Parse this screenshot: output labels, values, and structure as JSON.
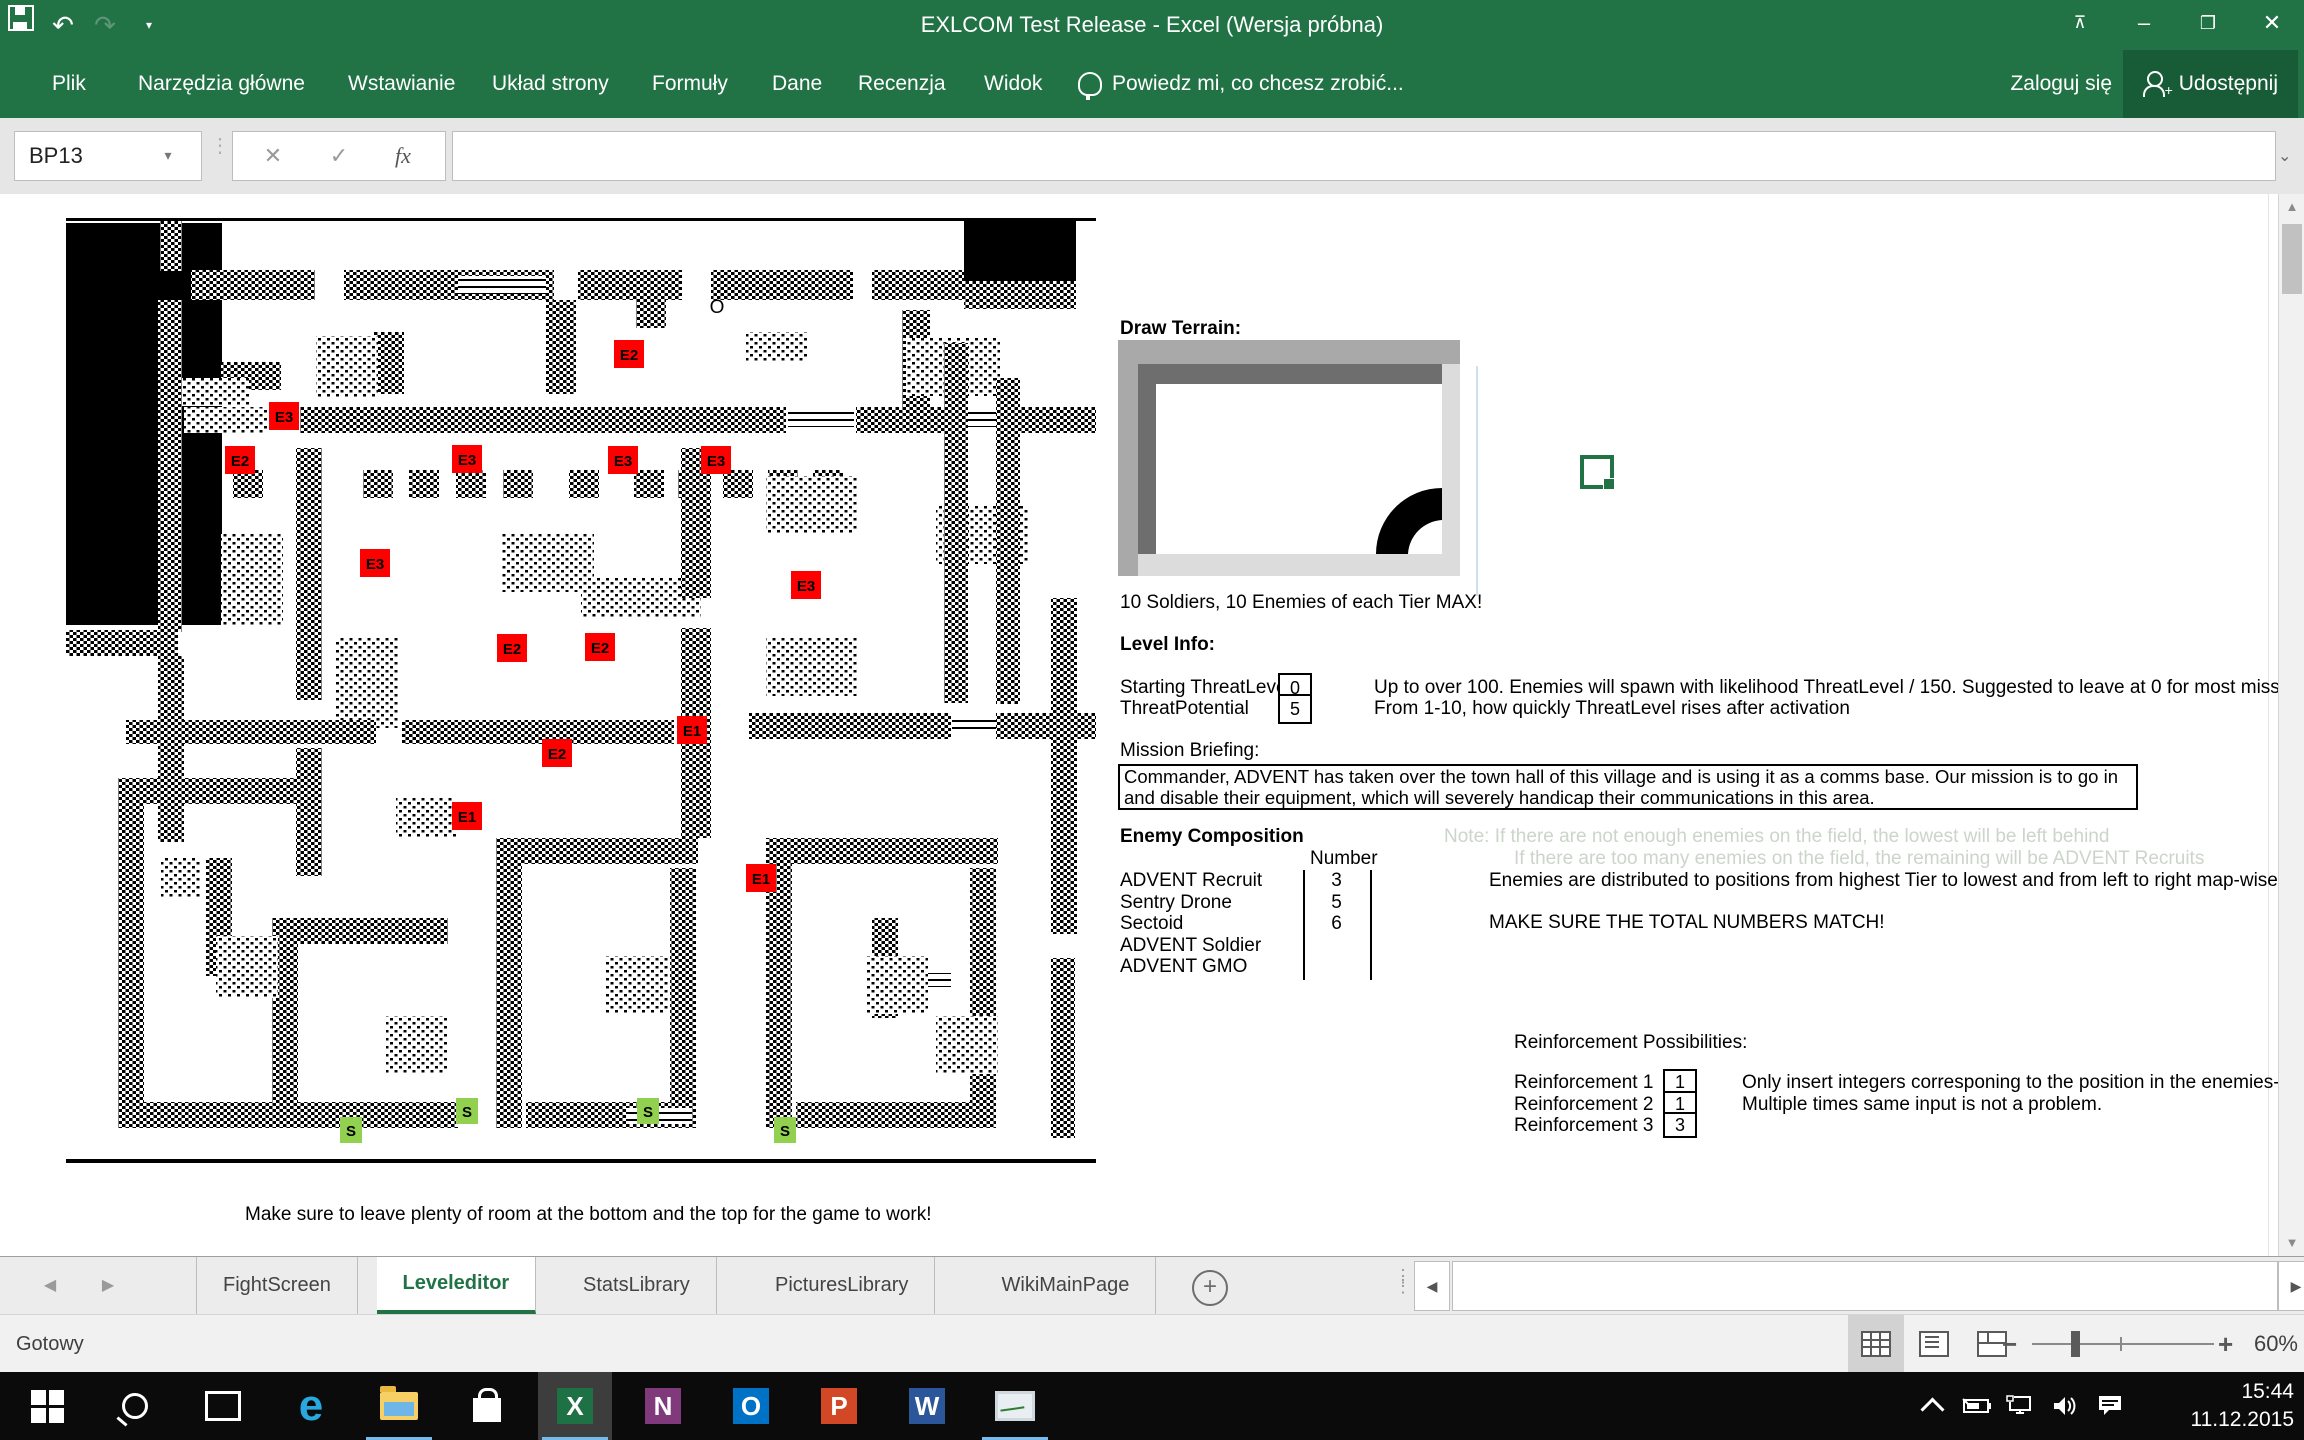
{
  "colors": {
    "excel_green": "#217346",
    "share_green": "#185c37",
    "enemy_red": "#fe0000",
    "soldier_green": "#92d050",
    "taskbar_accent": "#76b9ed"
  },
  "titlebar": {
    "title": "EXLCOM Test Release - Excel (Wersja próbna)",
    "quick_access": [
      "save",
      "undo",
      "redo",
      "customize"
    ],
    "window_buttons": [
      "ribbon-display-options",
      "minimize",
      "restore",
      "close"
    ]
  },
  "ribbon": {
    "tabs": [
      {
        "label": "Plik",
        "x": 30
      },
      {
        "label": "Narzędzia główne",
        "x": 116
      },
      {
        "label": "Wstawianie",
        "x": 326
      },
      {
        "label": "Układ strony",
        "x": 470
      },
      {
        "label": "Formuły",
        "x": 630
      },
      {
        "label": "Dane",
        "x": 750
      },
      {
        "label": "Recenzja",
        "x": 836
      },
      {
        "label": "Widok",
        "x": 962
      }
    ],
    "tell_me": "Powiedz mi, co chcesz zrobić...",
    "sign_in": "Zaloguj się",
    "share": "Udostępnij"
  },
  "formula_bar": {
    "name_box": "BP13",
    "cancel": "✕",
    "enter": "✓",
    "fx": "fx"
  },
  "map": {
    "o_marker": {
      "label": "O",
      "x": 651,
      "y": 95
    },
    "block_types": {
      "b": "black",
      "d": "wall-dither",
      "l": "floor-dither",
      "w": "window"
    },
    "blocks": [
      [
        "b",
        0,
        0,
        1030,
        3
      ],
      [
        "b",
        0,
        941,
        1030,
        4
      ],
      [
        "b",
        0,
        5,
        156,
        402
      ],
      [
        "b",
        898,
        3,
        112,
        60
      ],
      [
        "d",
        94,
        3,
        22,
        50
      ],
      [
        "d",
        125,
        52,
        124,
        30
      ],
      [
        "d",
        278,
        52,
        210,
        30
      ],
      [
        "d",
        512,
        52,
        104,
        30
      ],
      [
        "d",
        645,
        52,
        142,
        30
      ],
      [
        "d",
        806,
        52,
        92,
        30
      ],
      [
        "d",
        898,
        63,
        112,
        28
      ],
      [
        "w",
        392,
        58,
        88,
        18
      ],
      [
        "d",
        480,
        82,
        30,
        94
      ],
      [
        "d",
        308,
        114,
        30,
        62
      ],
      [
        "d",
        570,
        82,
        30,
        28
      ],
      [
        "d",
        836,
        92,
        28,
        122
      ],
      [
        "d",
        155,
        144,
        60,
        28
      ],
      [
        "l",
        250,
        118,
        62,
        62
      ],
      [
        "l",
        680,
        114,
        62,
        30
      ],
      [
        "l",
        840,
        120,
        94,
        58
      ],
      [
        "l",
        95,
        160,
        88,
        28
      ],
      [
        "d",
        92,
        82,
        24,
        332
      ],
      [
        "d",
        0,
        412,
        112,
        26
      ],
      [
        "d",
        92,
        438,
        26,
        186
      ],
      [
        "l",
        118,
        189,
        84,
        26
      ],
      [
        "d",
        234,
        189,
        486,
        26
      ],
      [
        "w",
        722,
        193,
        66,
        16
      ],
      [
        "d",
        790,
        189,
        92,
        26
      ],
      [
        "w",
        884,
        193,
        60,
        16
      ],
      [
        "d",
        946,
        189,
        84,
        26
      ],
      [
        "d",
        167,
        252,
        30,
        28
      ],
      [
        "d",
        297,
        252,
        30,
        28
      ],
      [
        "d",
        343,
        252,
        30,
        28
      ],
      [
        "d",
        390,
        252,
        30,
        28
      ],
      [
        "d",
        437,
        252,
        30,
        28
      ],
      [
        "d",
        503,
        252,
        30,
        28
      ],
      [
        "d",
        568,
        252,
        30,
        28
      ],
      [
        "d",
        612,
        252,
        30,
        28
      ],
      [
        "d",
        657,
        252,
        30,
        28
      ],
      [
        "d",
        702,
        252,
        30,
        28
      ],
      [
        "d",
        747,
        252,
        30,
        28
      ],
      [
        "l",
        155,
        316,
        62,
        92
      ],
      [
        "l",
        436,
        316,
        92,
        58
      ],
      [
        "l",
        700,
        258,
        92,
        58
      ],
      [
        "l",
        870,
        288,
        92,
        58
      ],
      [
        "l",
        270,
        420,
        62,
        90
      ],
      [
        "l",
        700,
        420,
        92,
        58
      ],
      [
        "l",
        515,
        360,
        120,
        40
      ],
      [
        "d",
        230,
        230,
        26,
        252
      ],
      [
        "d",
        230,
        530,
        26,
        128
      ],
      [
        "d",
        615,
        230,
        30,
        150
      ],
      [
        "d",
        615,
        410,
        30,
        210
      ],
      [
        "d",
        878,
        125,
        24,
        360
      ],
      [
        "d",
        930,
        160,
        24,
        326
      ],
      [
        "d",
        683,
        495,
        202,
        26
      ],
      [
        "d",
        930,
        495,
        100,
        26
      ],
      [
        "w",
        886,
        499,
        44,
        16
      ],
      [
        "d",
        60,
        502,
        250,
        24
      ],
      [
        "d",
        336,
        502,
        272,
        24
      ],
      [
        "d",
        52,
        560,
        26,
        330
      ],
      [
        "d",
        78,
        560,
        152,
        26
      ],
      [
        "d",
        140,
        640,
        26,
        118
      ],
      [
        "d",
        52,
        884,
        252,
        26
      ],
      [
        "d",
        206,
        700,
        26,
        210
      ],
      [
        "d",
        232,
        700,
        150,
        26
      ],
      [
        "d",
        152,
        884,
        240,
        26
      ],
      [
        "d",
        430,
        620,
        26,
        290
      ],
      [
        "d",
        456,
        620,
        176,
        26
      ],
      [
        "d",
        604,
        650,
        26,
        234
      ],
      [
        "d",
        460,
        884,
        170,
        26
      ],
      [
        "w",
        560,
        890,
        66,
        16
      ],
      [
        "d",
        700,
        620,
        26,
        290
      ],
      [
        "d",
        726,
        620,
        206,
        26
      ],
      [
        "d",
        904,
        650,
        26,
        234
      ],
      [
        "d",
        730,
        884,
        200,
        26
      ],
      [
        "w",
        845,
        755,
        40,
        14
      ],
      [
        "d",
        806,
        700,
        26,
        100
      ],
      [
        "d",
        985,
        380,
        26,
        336
      ],
      [
        "d",
        985,
        740,
        24,
        180
      ],
      [
        "l",
        150,
        718,
        62,
        62
      ],
      [
        "l",
        540,
        738,
        62,
        58
      ],
      [
        "l",
        800,
        738,
        62,
        58
      ],
      [
        "l",
        320,
        798,
        62,
        58
      ],
      [
        "l",
        870,
        798,
        62,
        58
      ],
      [
        "l",
        95,
        640,
        40,
        40
      ],
      [
        "l",
        330,
        580,
        60,
        40
      ]
    ],
    "units": [
      {
        "label": "E2",
        "x": 548,
        "y": 122
      },
      {
        "label": "E3",
        "x": 203,
        "y": 184
      },
      {
        "label": "E2",
        "x": 159,
        "y": 228
      },
      {
        "label": "E3",
        "x": 386,
        "y": 227
      },
      {
        "label": "E3",
        "x": 542,
        "y": 228
      },
      {
        "label": "E3",
        "x": 635,
        "y": 228
      },
      {
        "label": "E3",
        "x": 294,
        "y": 331
      },
      {
        "label": "E3",
        "x": 725,
        "y": 353
      },
      {
        "label": "E2",
        "x": 431,
        "y": 416
      },
      {
        "label": "E2",
        "x": 519,
        "y": 415
      },
      {
        "label": "E1",
        "x": 611,
        "y": 498
      },
      {
        "label": "E2",
        "x": 476,
        "y": 521
      },
      {
        "label": "E1",
        "x": 386,
        "y": 584
      },
      {
        "label": "E1",
        "x": 680,
        "y": 646
      },
      {
        "label": "S",
        "x": 274,
        "y": 899,
        "type": "soldier"
      },
      {
        "label": "S",
        "x": 390,
        "y": 880,
        "type": "soldier"
      },
      {
        "label": "S",
        "x": 571,
        "y": 880,
        "type": "soldier"
      },
      {
        "label": "S",
        "x": 708,
        "y": 899,
        "type": "soldier"
      }
    ],
    "footnote": "Make sure to leave plenty of room at the bottom and the top for the game to work!"
  },
  "panel": {
    "draw_terrain_label": "Draw Terrain:",
    "max_note": "10 Soldiers, 10 Enemies of each Tier MAX!",
    "level_info": {
      "title": "Level Info:",
      "rows": [
        {
          "label": "Starting ThreatLevel",
          "value": "0",
          "desc": "Up to over 100. Enemies will spawn with likelihood ThreatLevel / 150. Suggested to leave at 0 for most missions."
        },
        {
          "label": "ThreatPotential",
          "value": "5",
          "desc": "From 1-10, how quickly ThreatLevel rises after activation"
        }
      ]
    },
    "mission_briefing": {
      "label": "Mission Briefing:",
      "text": "Commander, ADVENT has taken over the town hall of this village and is using it as a comms base. Our mission is to go in and disable their equipment, which will severely handicap their communications in this area."
    },
    "enemy_composition": {
      "title": "Enemy Composition",
      "number_header": "Number",
      "rows": [
        {
          "name": "ADVENT Recruit",
          "value": "3"
        },
        {
          "name": "Sentry Drone",
          "value": "5"
        },
        {
          "name": "Sectoid",
          "value": "6"
        },
        {
          "name": "ADVENT Soldier",
          "value": ""
        },
        {
          "name": "ADVENT GMO",
          "value": ""
        }
      ],
      "notes_faint": [
        "Note: If there are not enough enemies on the field, the lowest will be left behind",
        "If there are too many enemies on the field, the remaining will be ADVENT Recruits"
      ],
      "note": "Enemies are distributed to positions from highest Tier to lowest and from left to right map-wise",
      "warning": "MAKE SURE THE TOTAL NUMBERS MATCH!"
    },
    "reinforcements": {
      "title": "Reinforcement Possibilities:",
      "rows": [
        {
          "label": "Reinforcement 1",
          "value": "1"
        },
        {
          "label": "Reinforcement 2",
          "value": "1"
        },
        {
          "label": "Reinforcement 3",
          "value": "3"
        }
      ],
      "notes": [
        "Only insert integers corresponing to the position in the enemies-list. Fill out all 3!",
        "Multiple times same input is not a problem."
      ]
    }
  },
  "sheet_tabs": {
    "tabs": [
      "FightScreen",
      "Leveleditor",
      "StatsLibrary",
      "PicturesLibrary",
      "WikiMainPage"
    ],
    "active": "Leveleditor",
    "add_label": "+"
  },
  "status_bar": {
    "ready": "Gotowy",
    "zoom": "60%",
    "views": [
      "normal",
      "page-layout",
      "page-break-preview"
    ],
    "active_view": "normal"
  },
  "taskbar": {
    "icons": [
      "start",
      "search",
      "task-view",
      "edge",
      "file-explorer",
      "store",
      "excel",
      "onenote",
      "outlook",
      "powerpoint",
      "word",
      "task-manager"
    ],
    "active": "excel",
    "running": [
      "file-explorer",
      "excel",
      "task-manager"
    ],
    "tray": [
      "chevron-up",
      "battery",
      "network",
      "volume",
      "action-center"
    ],
    "clock_time": "15:44",
    "clock_date": "11.12.2015"
  }
}
